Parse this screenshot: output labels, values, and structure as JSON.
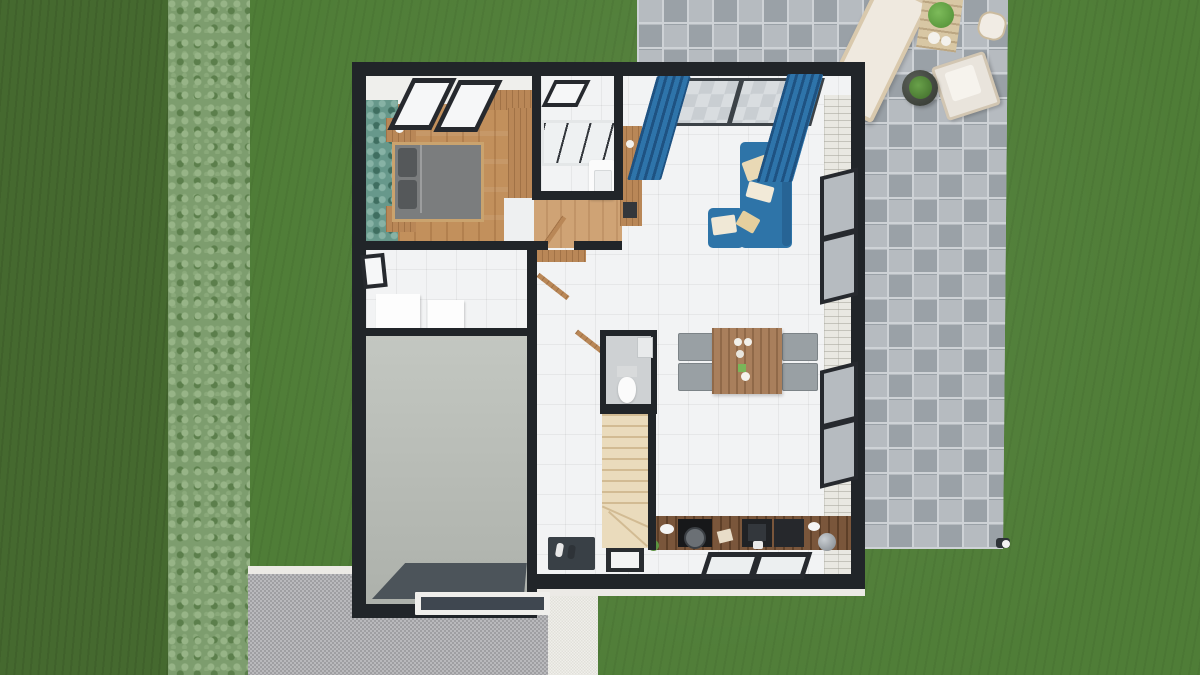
{
  "scene": {
    "description": "Top-down 3D render of a single-storey house floor plan set in a garden, as produced by a home-design tool",
    "view": "orthographic top view, slight 3D perspective",
    "visible_text": "none"
  },
  "palette": {
    "lawn_green": "#4f7d37",
    "lawn_dark_green": "#45692f",
    "hedge_green": "#7d9d6e",
    "patio_paver_gray": "#b3b8bd",
    "driveway_gravel_gray": "#a9a9ad",
    "walkway_white": "#eae8e2",
    "wall_black": "#212529",
    "wood_floor": "#c2905c",
    "wallpaper_teal": "#67988b",
    "tile_white": "#f2f3f4",
    "garage_floor_gray": "#b9bdb6",
    "stair_wood": "#eadbbc",
    "sofa_blue": "#2e74a8",
    "curtain_blue": "#2e74aa",
    "kitchen_counter_wood": "#7a563b",
    "furniture_wood": "#b98757",
    "bed_duvet_gray": "#7b7d7e",
    "garage_mat_dark": "#4c545a",
    "entry_mat_dark": "#394046"
  },
  "exterior": {
    "areas": [
      "lawn",
      "dark-lawn-strip",
      "hedge-row",
      "stone-paver-patio",
      "gravel-driveway",
      "white-walkway"
    ],
    "patio_furniture": [
      "garden-bench",
      "garden-table-with-salad-bowl",
      "garden-plates",
      "garden-armchair",
      "round-planter-with-plant",
      "garden-stool",
      "garden-light"
    ]
  },
  "rooms": [
    {
      "name": "bedroom",
      "floor": "wood",
      "items": [
        "double-bed",
        "nightstand-top",
        "nightstand-bottom",
        "wardrobe",
        "skylight-windows",
        "teal-wallpaper-wall"
      ]
    },
    {
      "name": "bathroom",
      "floor": "white-tile",
      "items": [
        "walk-in-shower",
        "vanity-sink",
        "skylight-window"
      ]
    },
    {
      "name": "landing-hall",
      "floor": "wood-and-tile",
      "items": [
        "coat-shelf",
        "stair-handrails"
      ]
    },
    {
      "name": "wc",
      "floor": "gray-tile",
      "items": [
        "toilet",
        "corner-sink"
      ]
    },
    {
      "name": "staircase",
      "floor": "light-wood",
      "items": [
        "straight-flight",
        "winder-steps"
      ]
    },
    {
      "name": "laundry-storage",
      "floor": "white",
      "items": [
        "washer-box",
        "dryer-box",
        "small-window"
      ]
    },
    {
      "name": "garage",
      "floor": "gray-concrete",
      "items": [
        "dark-floor-mat",
        "garage-door"
      ]
    },
    {
      "name": "living-dining-kitchen",
      "floor": "white-tile",
      "items": [
        "blue-corner-sofa",
        "sofa-cushions",
        "console-shelf",
        "dining-table",
        "four-chairs",
        "kitchen-counter",
        "cooktop",
        "sink-unit",
        "kettle",
        "floor-skylight",
        "patio-sliding-door",
        "blue-curtains",
        "two-facade-windows",
        "white-brick-feature-wall"
      ]
    },
    {
      "name": "entry",
      "floor": "white-tile",
      "items": [
        "door-mat",
        "shoes",
        "front-door"
      ]
    }
  ]
}
